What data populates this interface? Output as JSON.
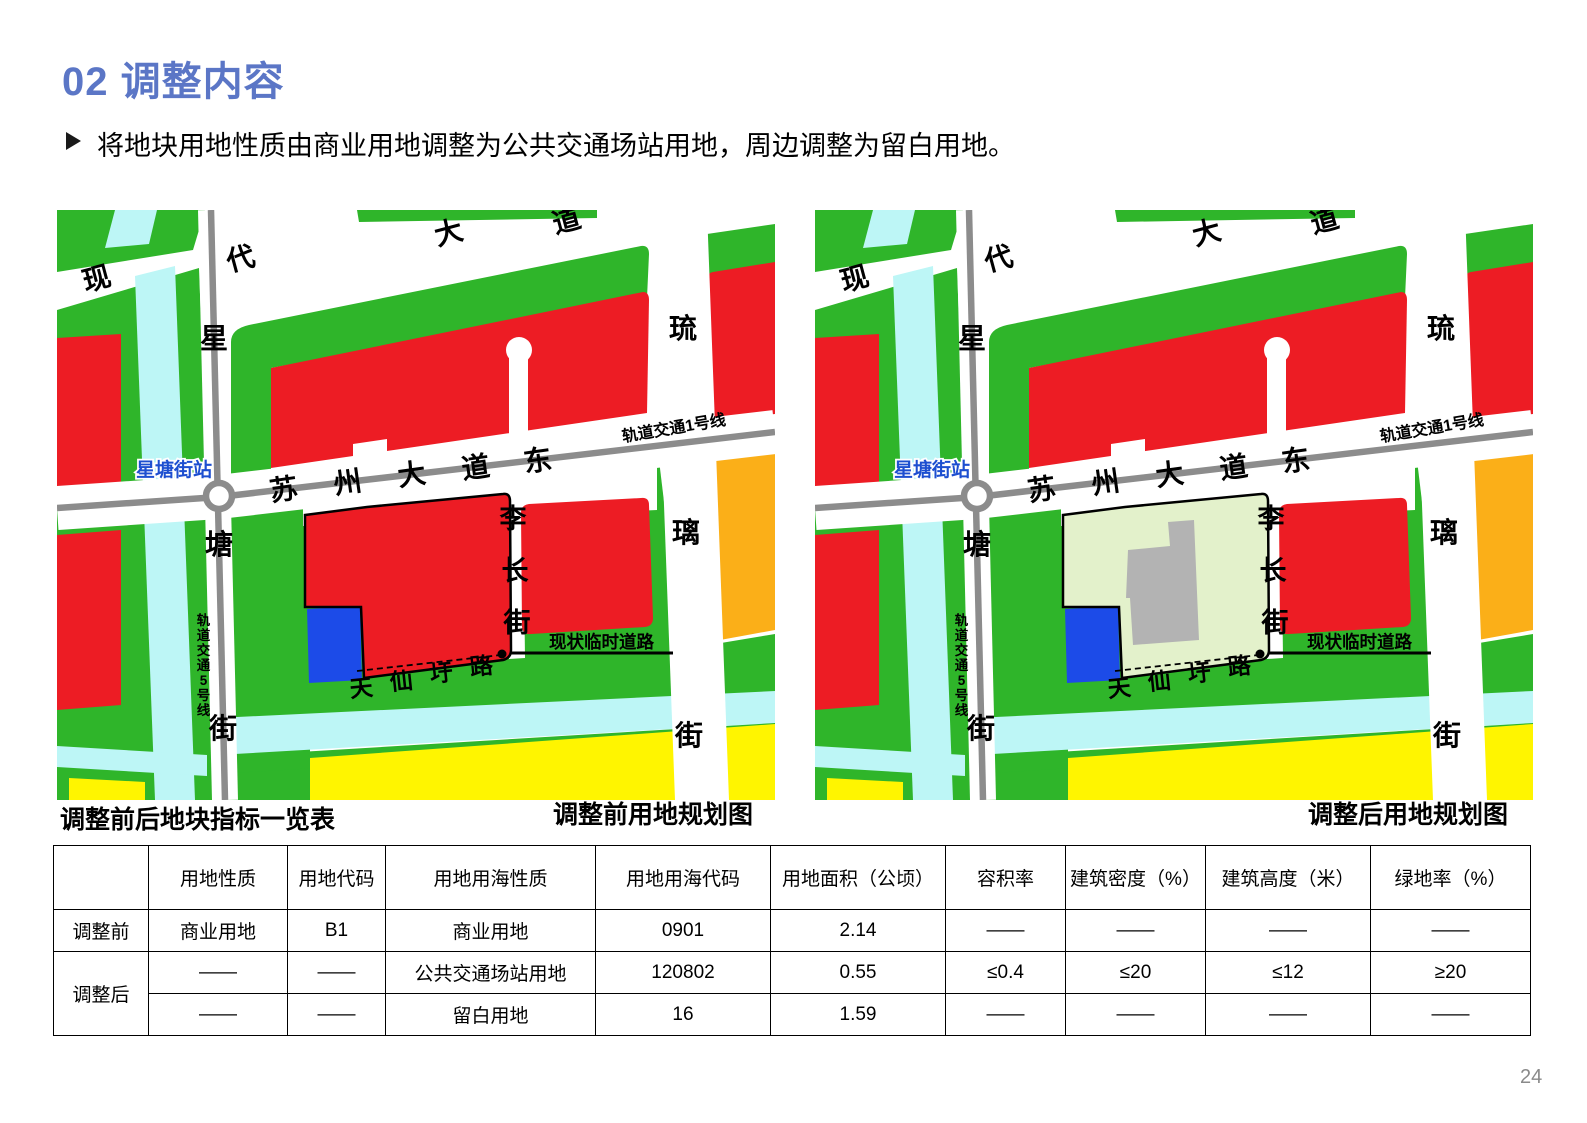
{
  "page": {
    "title": "02 调整内容",
    "bullet_arrow": "➢",
    "bullet": "将地块用地性质由商业用地调整为公共交通场站用地，周边调整为留白用地。",
    "page_number": "24"
  },
  "captions": {
    "table_title": "调整前后地块指标一览表",
    "before_map": "调整前用地规划图",
    "after_map": "调整后用地规划图"
  },
  "map_labels": {
    "modern_avenue": "现代大道",
    "xingtang_street": "星塘街",
    "suzhou_avenue_east": "苏州大道东",
    "rail_line_1": "轨道交通1号线",
    "rail_line_5": "轨道交通5号线",
    "station": "星塘街站",
    "liuli_street": "琉璃街",
    "lichang_street": "李长街",
    "tianxianwei_road": "天仙圩路",
    "temp_road": "现状临时道路"
  },
  "colors": {
    "red": "#ED1C24",
    "green": "#2FB52A",
    "cyan": "#BDF6F6",
    "yellow": "#FFF500",
    "orange": "#FBAF18",
    "blue": "#1C4BE8",
    "pale_green": "#E3F1CB",
    "building_gray": "#B3B3B3",
    "road_gray": "#8C8C8C",
    "station_blue": "#1D4FD0",
    "title_blue": "#5B76C6"
  },
  "table": {
    "headers": [
      "",
      "用地性质",
      "用地代码",
      "用地用海性质",
      "用地用海代码",
      "用地面积（公顷）",
      "容积率",
      "建筑密度（%）",
      "建筑高度（米）",
      "绿地率（%）"
    ],
    "rows": [
      {
        "label": "调整前",
        "cells": [
          "商业用地",
          "B1",
          "商业用地",
          "0901",
          "2.14",
          "——",
          "——",
          "——",
          "——"
        ]
      },
      {
        "label": "调整后",
        "cells": [
          "——",
          "——",
          "公共交通场站用地",
          "120802",
          "0.55",
          "≤0.4",
          "≤20",
          "≤12",
          "≥20"
        ]
      },
      {
        "label": "",
        "cells": [
          "——",
          "——",
          "留白用地",
          "16",
          "1.59",
          "——",
          "——",
          "——",
          "——"
        ]
      }
    ]
  }
}
